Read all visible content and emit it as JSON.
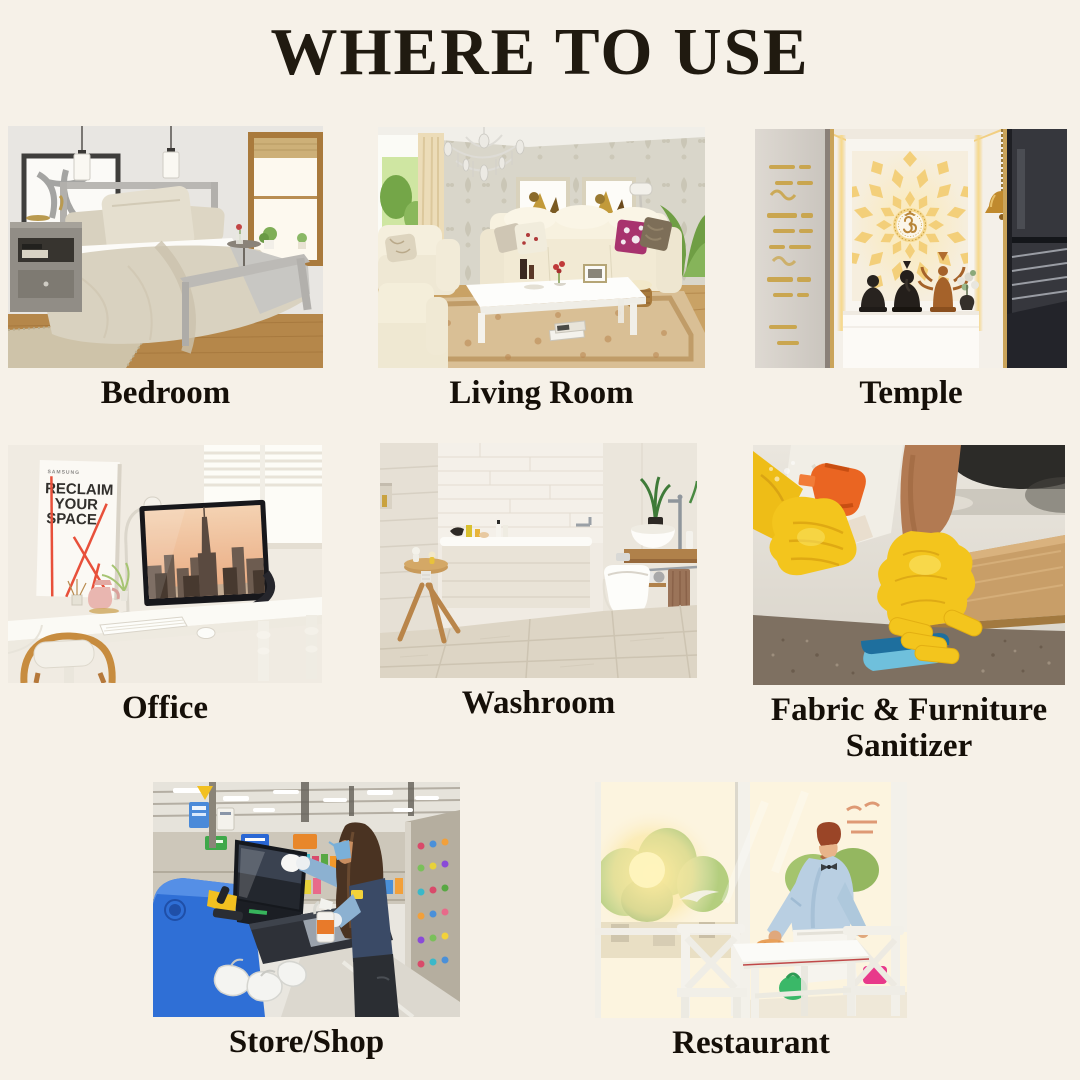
{
  "page": {
    "title": "WHERE TO USE",
    "background": "#f6f1e8",
    "title_color": "#201a10",
    "label_color": "#150f08"
  },
  "items": [
    {
      "id": "bedroom",
      "label": "Bedroom",
      "alt": "Bedroom with metal-frame bed, beige bedding, pendant lamps, nightstand, framed art and a window"
    },
    {
      "id": "living-room",
      "label": "Living Room",
      "alt": "Living room with crystal chandelier, cream sofas, white coffee table, wall art and patterned rug"
    },
    {
      "id": "temple",
      "label": "Temple",
      "alt": "Home temple with backlit Om mandala panel, hanging brass bell and idols on a white counter"
    },
    {
      "id": "office",
      "label": "Office",
      "alt": "Office desk with monitor showing a city skyline, poster on wall, keyboard, mouse and wooden chair"
    },
    {
      "id": "washroom",
      "label": "Washroom",
      "alt": "Washroom with bathtub, wall-hung toilet, vessel sink on wooden counter, stool and plant"
    },
    {
      "id": "fabric",
      "label": "Fabric & Furniture Sanitizer",
      "alt": "Yellow-gloved hands spraying sanitizer from an orange bottle and wiping a surface with a blue sponge"
    },
    {
      "id": "store",
      "label": "Store/Shop",
      "alt": "Store worker in a mask disinfecting a blue self-checkout machine screen"
    },
    {
      "id": "restaurant",
      "label": "Restaurant",
      "alt": "Waiter in a blue shirt and white apron wiping a white table by sunny windows"
    }
  ],
  "office_poster": {
    "brand": "SAMSUNG",
    "line1": "RECLAIM",
    "line2": "YOUR",
    "line3": "SPACE"
  }
}
